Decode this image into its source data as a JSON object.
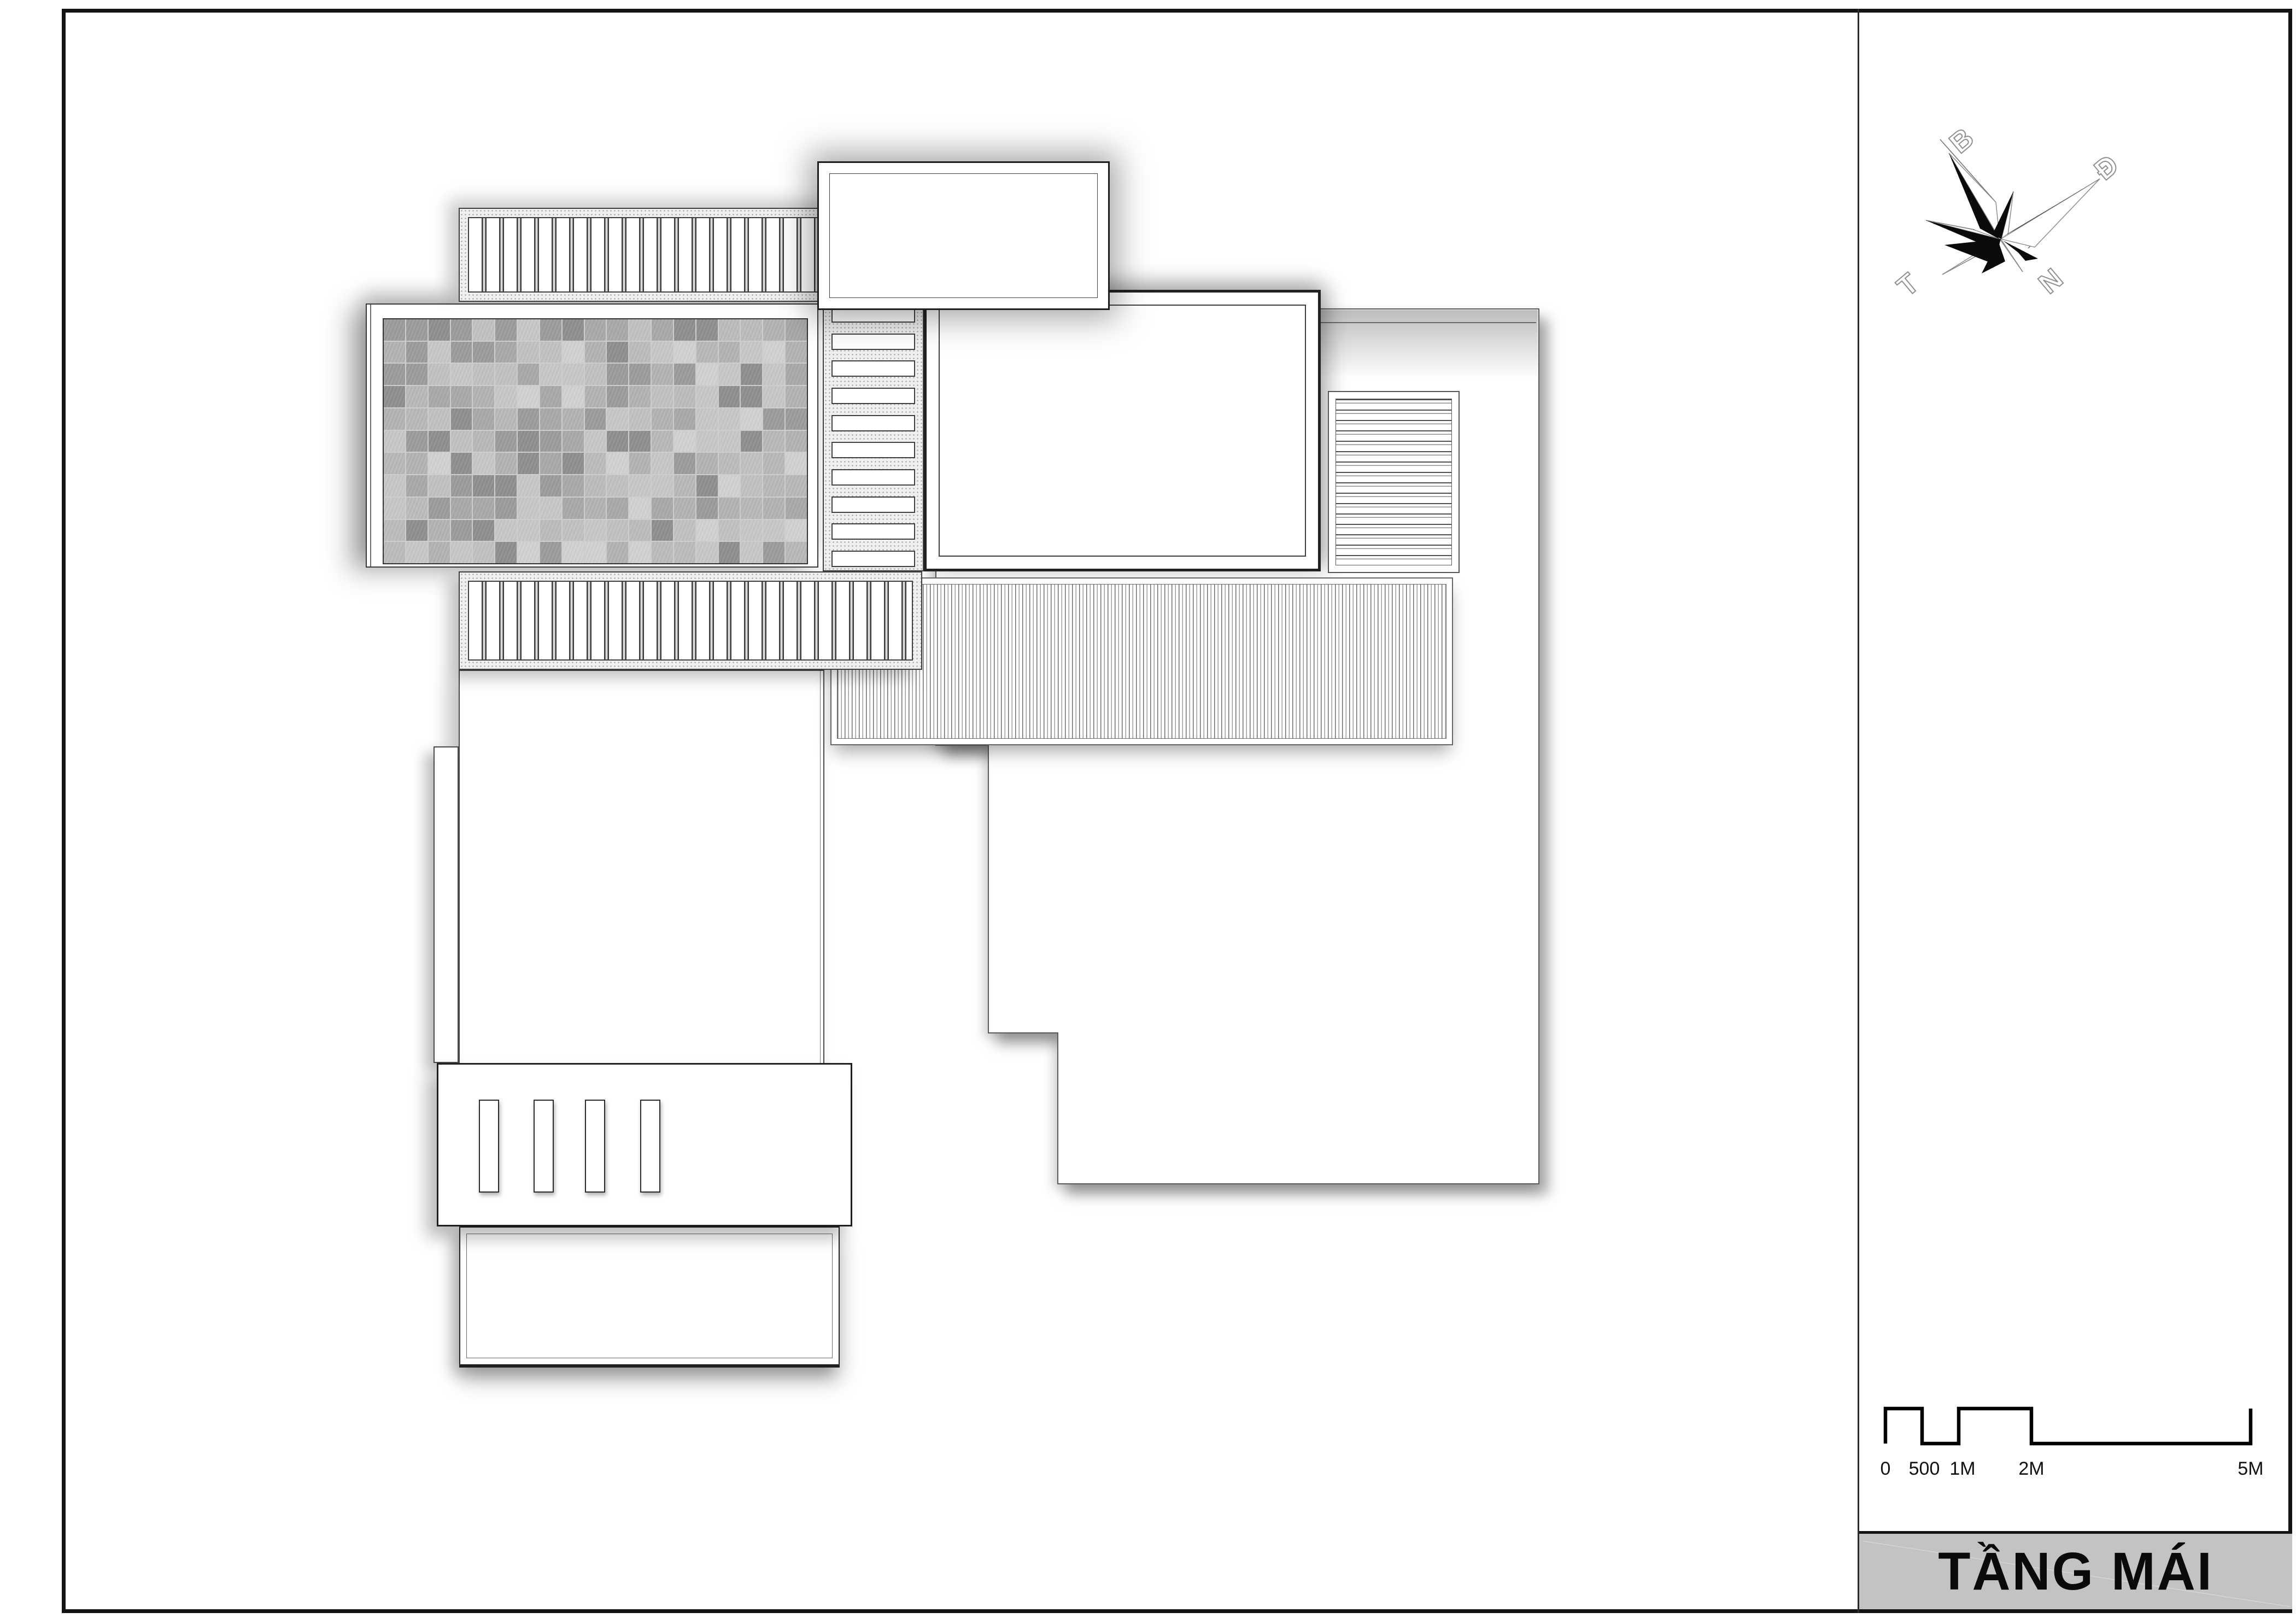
{
  "drawing": {
    "title_block": {
      "label": "TẦNG MÁI",
      "bg": "#c3c3c3",
      "border": "#131313",
      "text_color": "#0a0a0a"
    },
    "compass": {
      "north_label": "B",
      "east_label": "Đ",
      "south_label": "N",
      "west_label": "T"
    },
    "scale_bar": {
      "labels": [
        "0",
        "500",
        "1M",
        "2M",
        "5M"
      ],
      "color": "#000000"
    },
    "colors": {
      "paper": "#ffffff",
      "frame_line": "#141414",
      "plan_line_dark": "#1f1f1f",
      "plan_line_mid": "#555555",
      "stipple_bg": "#efefef",
      "stipple_dot": "#999999",
      "shadow": "rgba(0,0,0,0.30)"
    },
    "tiles": {
      "rows": 11,
      "cols": 19,
      "seed": 11,
      "grout": "#cdcdcd",
      "shades": [
        "#c7c7c7",
        "#bcbcbc",
        "#b3b3b3",
        "#a9a9a9",
        "#9c9c9c",
        "#8f8f8f",
        "#d1d1d1",
        "#c1c1c1",
        "#b8b8b8"
      ]
    },
    "louver_ladder": {
      "bar_count": 10
    },
    "canopy_slats": {
      "count": 4
    }
  }
}
